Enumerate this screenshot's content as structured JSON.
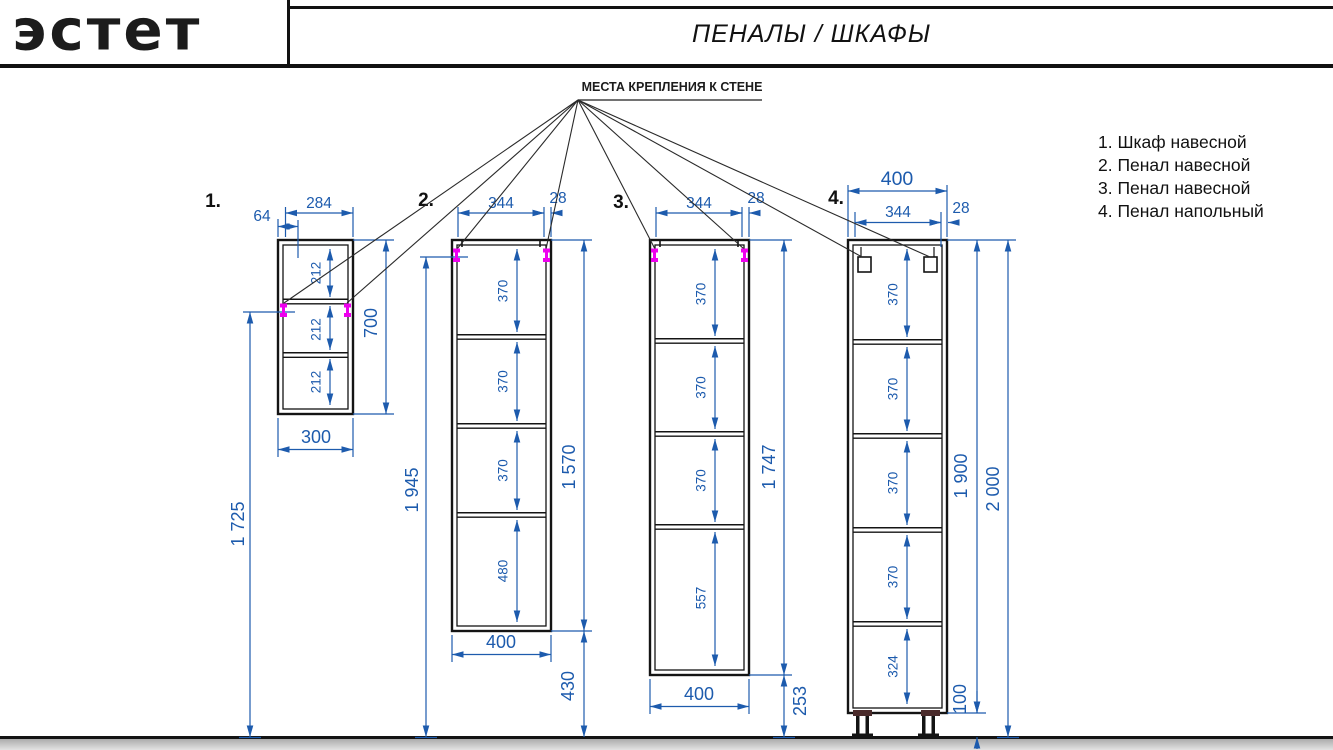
{
  "header": {
    "logo_text": "эстет",
    "title": "ПЕНАЛЫ / ШКАФЫ"
  },
  "annotation": "МЕСТА КРЕПЛЕНИЯ К СТЕНЕ",
  "legend": [
    "1. Шкаф навесной",
    "2. Пенал навесной",
    "3. Пенал навесной",
    "4. Пенал напольный"
  ],
  "cabinets": [
    {
      "label": "1.",
      "top_width": "284",
      "door_offset": "64",
      "compartments": [
        "212",
        "212",
        "212"
      ],
      "height": "700",
      "bottom_width": "300",
      "mount_height": "1 725"
    },
    {
      "label": "2.",
      "top_width": "344",
      "side_offset": "28",
      "compartments": [
        "370",
        "370",
        "370",
        "480"
      ],
      "height": "1 570",
      "bottom_width": "400",
      "floor_clearance": "430",
      "mount_height": "1 945"
    },
    {
      "label": "3.",
      "top_width": "344",
      "side_offset": "28",
      "compartments": [
        "370",
        "370",
        "370",
        "557"
      ],
      "height": "1 747",
      "bottom_width": "400",
      "floor_clearance": "253"
    },
    {
      "label": "4.",
      "outer_width": "400",
      "top_width": "344",
      "side_offset": "28",
      "compartments": [
        "370",
        "370",
        "370",
        "370",
        "324"
      ],
      "height": "1 900",
      "total_height": "2 000",
      "leg_height": "100"
    }
  ],
  "colors": {
    "dimension_blue": "#1d5bad",
    "mount_magenta": "#ee00ee",
    "drawing_black": "#141414",
    "floor_gray": "#c4c4c4"
  }
}
